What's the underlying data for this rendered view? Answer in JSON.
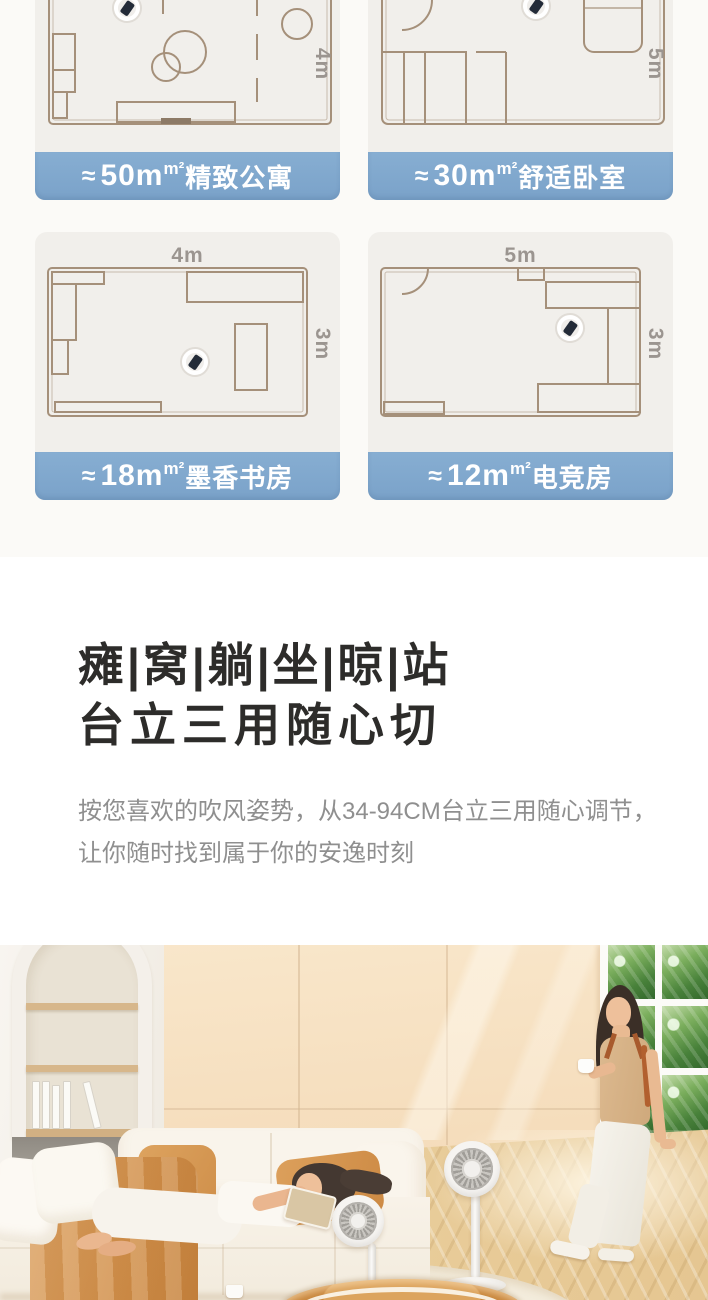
{
  "rooms": {
    "cards": [
      {
        "approx": "≈",
        "size": "50m",
        "unit": "m²",
        "name": "精致公寓",
        "side": "4m"
      },
      {
        "approx": "≈",
        "size": "30m",
        "unit": "m²",
        "name": "舒适卧室",
        "side": "5m"
      },
      {
        "approx": "≈",
        "size": "18m",
        "unit": "m²",
        "name": "墨香书房",
        "side": "3m",
        "top": "4m"
      },
      {
        "approx": "≈",
        "size": "12m",
        "unit": "m²",
        "name": "电竞房",
        "side": "3m",
        "top": "5m"
      }
    ]
  },
  "headline": {
    "line1": "瘫|窝|躺|坐|晾|站",
    "line2": "台立三用随心切"
  },
  "description": {
    "line1": "按您喜欢的吹风姿势，从34-94CM台立三用随心调节，",
    "line2": "让你随时找到属于你的安逸时刻"
  },
  "colors": {
    "accent_blue": "#7fa8cd",
    "plan_line": "#a5907a",
    "card_bg": "#f1efeb",
    "heading_text": "#2d2c2a",
    "body_text": "#8f8f8f"
  }
}
